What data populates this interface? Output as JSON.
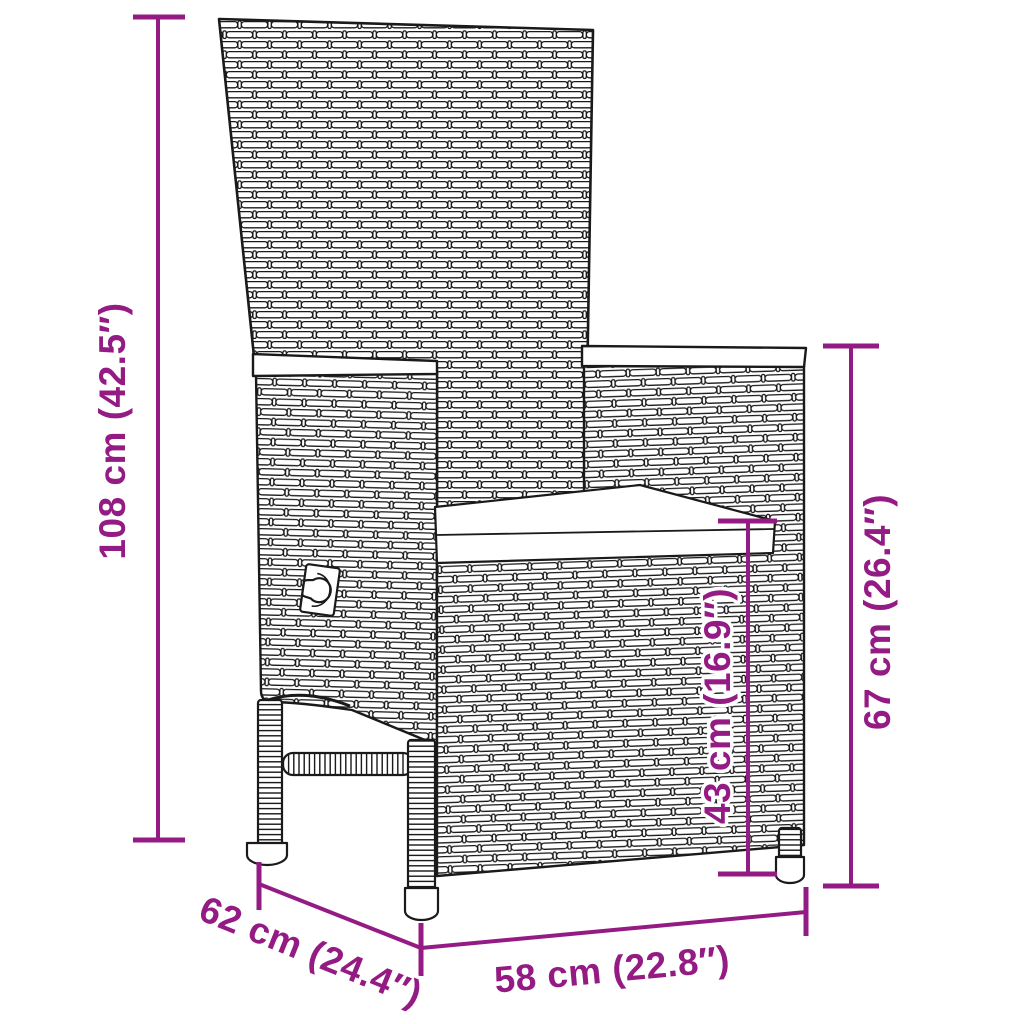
{
  "figure": {
    "alt": "Line drawing of a poly rattan reclining garden chair with a seat cushion, shown with product dimensions"
  },
  "dimension_labels": {
    "total_height": "108 cm (42.5″)",
    "armrest_height": "67 cm (26.4″)",
    "seat_height": "43 cm (16.9″)",
    "depth": "62 cm (24.4″)",
    "width": "58 cm (22.8″)"
  },
  "colors": {
    "dimension_accent": "#951b84",
    "outline": "#1a1a1a",
    "background": "#ffffff"
  }
}
